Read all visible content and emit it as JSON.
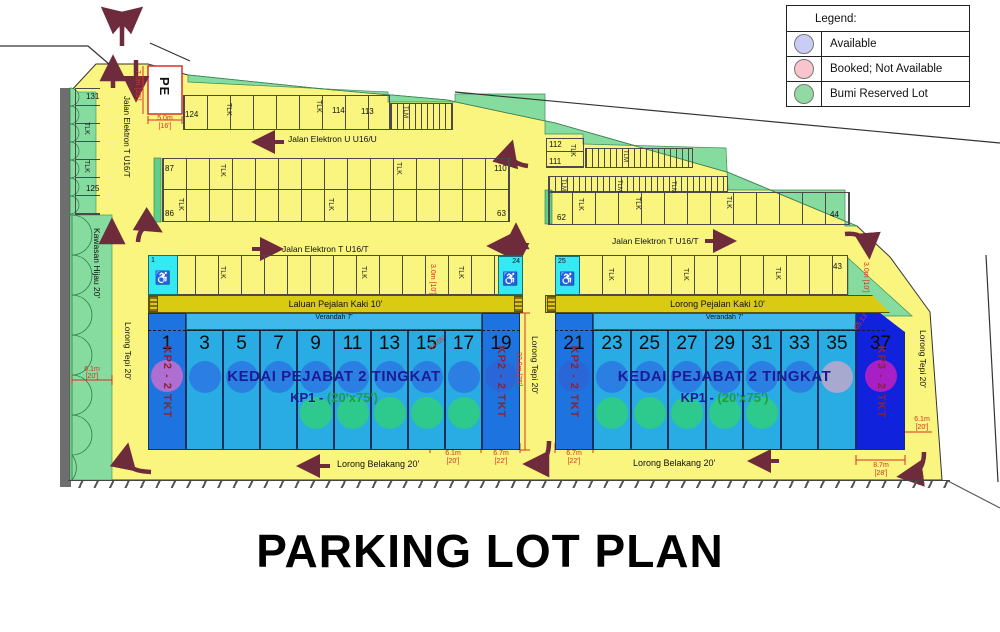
{
  "title": "PARKING LOT PLAN",
  "legend": {
    "header": "Legend:",
    "items": [
      {
        "label": "Available",
        "color": "#C9CDF5"
      },
      {
        "label": "Booked; Not Available",
        "color": "#F9C4CC"
      },
      {
        "label": "Bumi Reserved Lot",
        "color": "#93D9A3"
      }
    ]
  },
  "roads": {
    "jalan_u": "Jalan Elektron U U16/U",
    "jalan_t": "Jalan Elektron T U16/T",
    "laluan": "Laluan Pejalan Kaki 10'",
    "lorong_pejalan": "Lorong Pejalan Kaki 10'",
    "lorong_belakang": "Lorong Belakang 20'",
    "lorong_tepi": "Lorong Tepi 20'",
    "kawasan": "Kawasan Hijau 20'",
    "verandah": "Verandah 7'"
  },
  "labels": {
    "tlk": "TLK",
    "tlm": "TLM",
    "pe": "PE"
  },
  "numbers": {
    "n131": "131",
    "n125": "125",
    "n124": "124",
    "n114": "114",
    "n113": "113",
    "n110": "110",
    "n87": "87",
    "n86": "86",
    "n63": "63",
    "n62": "62",
    "n44": "44",
    "n43": "43",
    "n112": "112",
    "n111": "111",
    "s1": "1",
    "s24": "24",
    "s25": "25"
  },
  "dims": {
    "pe_h": "7.0m [23']",
    "pe_w1": "5.0m",
    "pe_w2": "[16']",
    "w3": "3.0m [10']",
    "v229": "22.9m [75']",
    "d61a": "6.1m",
    "d61b": "[20']",
    "d67a": "6.7m",
    "d67b": "[22']",
    "d87a": "8.7m",
    "d87b": "[28']",
    "diagL": "64.65'",
    "diagR": "65.13'"
  },
  "blocks": {
    "left": {
      "title": "KEDAI PEJABAT 2 TINGKAT",
      "sub_prefix": "KP1 - ",
      "sub_dim": "(20'x75')",
      "left_end": "KP2 - 2 TKT",
      "right_end": "KP2 - 2 TKT",
      "lots": [
        {
          "no": "1",
          "bg": "#1D74E0",
          "c1": "#AF6ED2",
          "c2": ""
        },
        {
          "no": "3",
          "bg": "#29ACE4",
          "c1": "#2B7FE2",
          "c2": ""
        },
        {
          "no": "5",
          "bg": "#29ACE4",
          "c1": "#2B7FE2",
          "c2": ""
        },
        {
          "no": "7",
          "bg": "#29ACE4",
          "c1": "#2B7FE2",
          "c2": ""
        },
        {
          "no": "9",
          "bg": "#29ACE4",
          "c1": "#2B7FE2",
          "c2": "#2EC98C"
        },
        {
          "no": "11",
          "bg": "#29ACE4",
          "c1": "#2B7FE2",
          "c2": "#2EC98C"
        },
        {
          "no": "13",
          "bg": "#29ACE4",
          "c1": "#2B7FE2",
          "c2": "#2EC98C"
        },
        {
          "no": "15",
          "bg": "#29ACE4",
          "c1": "#2B7FE2",
          "c2": "#2EC98C"
        },
        {
          "no": "17",
          "bg": "#29ACE4",
          "c1": "#2B7FE2",
          "c2": "#2EC98C"
        },
        {
          "no": "19",
          "bg": "#1D74E0",
          "c1": "#2B66D8",
          "c2": ""
        }
      ]
    },
    "right": {
      "title": "KEDAI PEJABAT 2 TINGKAT",
      "sub_prefix": "KP1 - ",
      "sub_dim": "(20'x75')",
      "left_end": "KP2 - 2 TKT",
      "right_end": "KP3 - 2 TKT",
      "lots": [
        {
          "no": "21",
          "bg": "#1D74E0",
          "c1": "#2B66D8",
          "c2": ""
        },
        {
          "no": "23",
          "bg": "#29ACE4",
          "c1": "#2B7FE2",
          "c2": "#2EC98C"
        },
        {
          "no": "25",
          "bg": "#29ACE4",
          "c1": "#2B7FE2",
          "c2": "#2EC98C"
        },
        {
          "no": "27",
          "bg": "#29ACE4",
          "c1": "#2B7FE2",
          "c2": "#2EC98C"
        },
        {
          "no": "29",
          "bg": "#29ACE4",
          "c1": "#2B7FE2",
          "c2": "#2EC98C"
        },
        {
          "no": "31",
          "bg": "#29ACE4",
          "c1": "#2B7FE2",
          "c2": "#2EC98C"
        },
        {
          "no": "33",
          "bg": "#29ACE4",
          "c1": "#2B7FE2",
          "c2": ""
        },
        {
          "no": "35",
          "bg": "#29ACE4",
          "c1": "#A7A9CE",
          "c2": ""
        },
        {
          "no": "37",
          "bg": "#1122DC",
          "c1": "#A81FC6",
          "c2": ""
        }
      ]
    }
  }
}
